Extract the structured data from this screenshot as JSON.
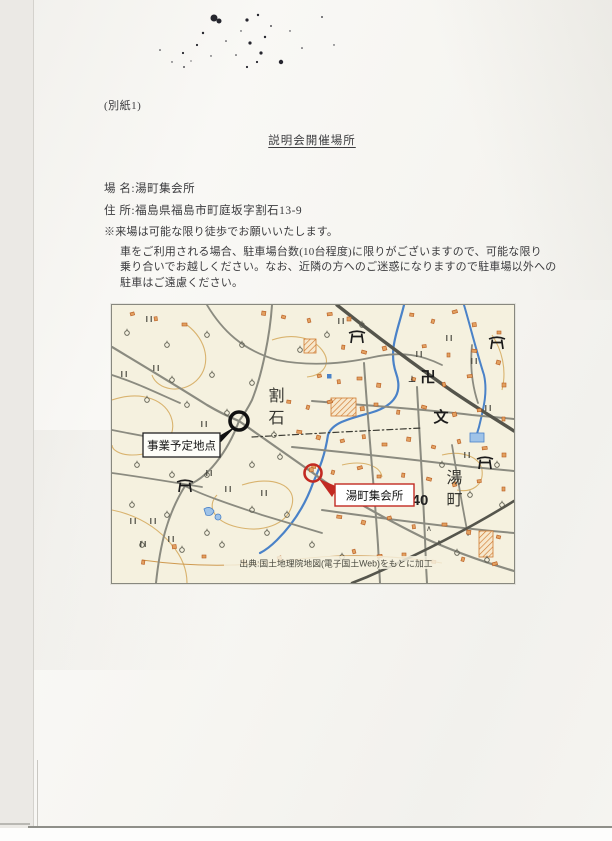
{
  "doc": {
    "attachment_label": "(別紙1)",
    "title": "説明会開催場所",
    "venue_line": "場 名:湯町集会所",
    "address_line": "住 所:福島県福島市町庭坂字割石13-9",
    "note_lines": [
      "※来場は可能な限り徒歩でお願いいたします。",
      "車をご利用される場合、駐車場台数(10台程度)に限りがございますので、可能な限り",
      "乗り合いでお越しください。なお、近隣の方へのご迷惑になりますので駐車場以外への",
      "駐車はご遠慮ください。"
    ]
  },
  "map": {
    "caption": "出典:国土地理院地図(電子国土Web)をもとに加工",
    "callouts": {
      "project_site": "事業予定地点",
      "meeting_hall": "湯町集会所"
    },
    "place_names": {
      "warishi": "割石",
      "yumachi": "湯町",
      "route_number": "40"
    },
    "symbols": {
      "temple": "卍",
      "school": "文",
      "grave": "⊥",
      "shrine_icon": "torii-gate",
      "paddy_icon": "rice-field-mark",
      "orchard_icon": "fruit-tree-mark"
    },
    "colors": {
      "map_background": "#f5f1df",
      "road": "#8b8b80",
      "major_road": "#55554c",
      "river": "#4a82c8",
      "contour": "#d9b36e",
      "building": "#d98b4a",
      "marker_black": "#111111",
      "marker_red": "#c22a22"
    }
  }
}
